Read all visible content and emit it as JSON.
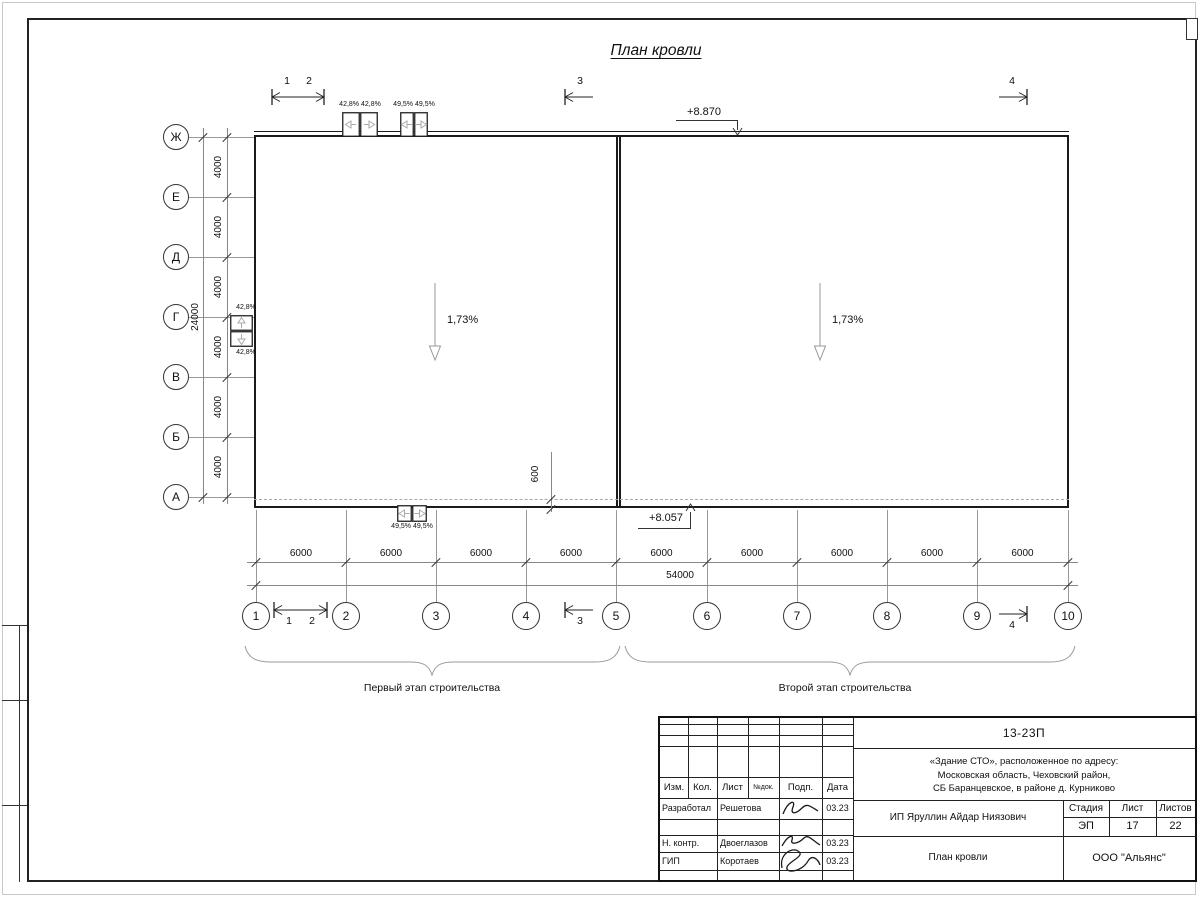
{
  "page_title": "План кровли",
  "axes": {
    "rows": [
      "Ж",
      "Е",
      "Д",
      "Г",
      "В",
      "Б",
      "А"
    ],
    "cols": [
      "1",
      "2",
      "3",
      "4",
      "5",
      "6",
      "7",
      "8",
      "9",
      "10"
    ]
  },
  "dims": {
    "row_segments": [
      "4000",
      "4000",
      "4000",
      "4000",
      "4000",
      "4000"
    ],
    "row_total": "24000",
    "col_segments": [
      "6000",
      "6000",
      "6000",
      "6000",
      "6000",
      "6000",
      "6000",
      "6000",
      "6000"
    ],
    "col_total": "54000",
    "parapet_offset": "600"
  },
  "slopes": {
    "left": "1,73%",
    "right": "1,73%",
    "funnel_top_a": "42,8% 42,8%",
    "funnel_top_b": "49,5% 49,5%",
    "funnel_bottom": "49,5% 49,5%",
    "funnel_left_top": "42,8%",
    "funnel_left_bottom": "42,8%"
  },
  "elevations": {
    "top": "+8.870",
    "bottom": "+8.057"
  },
  "sections": {
    "s1": "1",
    "s2": "2",
    "s3": "3",
    "s4": "4"
  },
  "stages": {
    "first": "Первый этап строительства",
    "second": "Второй этап строительства"
  },
  "titleblock": {
    "doc_number": "13-23П",
    "project_lines": [
      "«Здание СТО», расположенное по адресу:",
      "Московская область, Чеховский район,",
      "СБ Баранцевское, в районе д. Курниково"
    ],
    "header": {
      "izm": "Изм.",
      "kol": "Кол.",
      "list": "Лист",
      "ndok": "№док.",
      "podp": "Подп.",
      "data": "Дата"
    },
    "signers": [
      {
        "role": "Разработал",
        "name": "Решетова",
        "date": "03.23"
      },
      {
        "role": "Н. контр.",
        "name": "Двоеглазов",
        "date": "03.23"
      },
      {
        "role": "ГИП",
        "name": "Коротаев",
        "date": "03.23"
      }
    ],
    "client": "ИП Яруллин Айдар Ниязович",
    "sheet_name": "План кровли",
    "stage_label": "Стадия",
    "list_label": "Лист",
    "listov_label": "Листов",
    "stage": "ЭП",
    "list": "17",
    "listov": "22",
    "company": "ООО \"Альянс\""
  }
}
